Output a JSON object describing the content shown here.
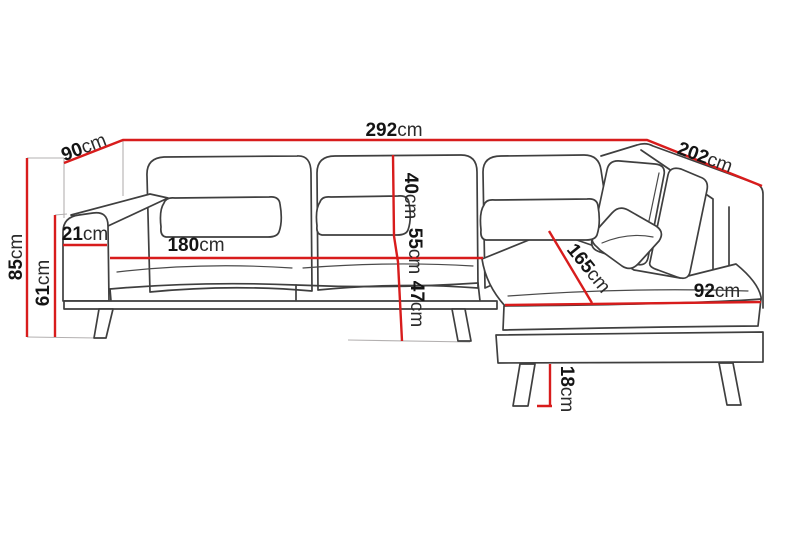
{
  "page": {
    "background": "#ffffff",
    "description": "Technical dimension diagram of an L-shaped corner sofa with right-hand chaise; black line drawing with red dimension lines and measurements in centimetres"
  },
  "colors": {
    "dimension_line": "#d81c1c",
    "outline": "#3f3f3f",
    "projection_line": "#b3b0b0",
    "label_text": "#141414"
  },
  "unit": "cm",
  "dims": {
    "total_width": {
      "value": "292",
      "unit": "cm"
    },
    "left_depth": {
      "value": "90",
      "unit": "cm"
    },
    "right_depth": {
      "value": "202",
      "unit": "cm"
    },
    "total_height": {
      "value": "85",
      "unit": "cm"
    },
    "armrest_height": {
      "value": "61",
      "unit": "cm"
    },
    "armrest_width": {
      "value": "21",
      "unit": "cm"
    },
    "seat_width": {
      "value": "180",
      "unit": "cm"
    },
    "backrest_height": {
      "value": "40",
      "unit": "cm"
    },
    "seat_depth": {
      "value": "55",
      "unit": "cm"
    },
    "seat_height": {
      "value": "47",
      "unit": "cm"
    },
    "chaise_length": {
      "value": "165",
      "unit": "cm"
    },
    "chaise_width": {
      "value": "92",
      "unit": "cm"
    },
    "leg_height": {
      "value": "18",
      "unit": "cm"
    }
  }
}
